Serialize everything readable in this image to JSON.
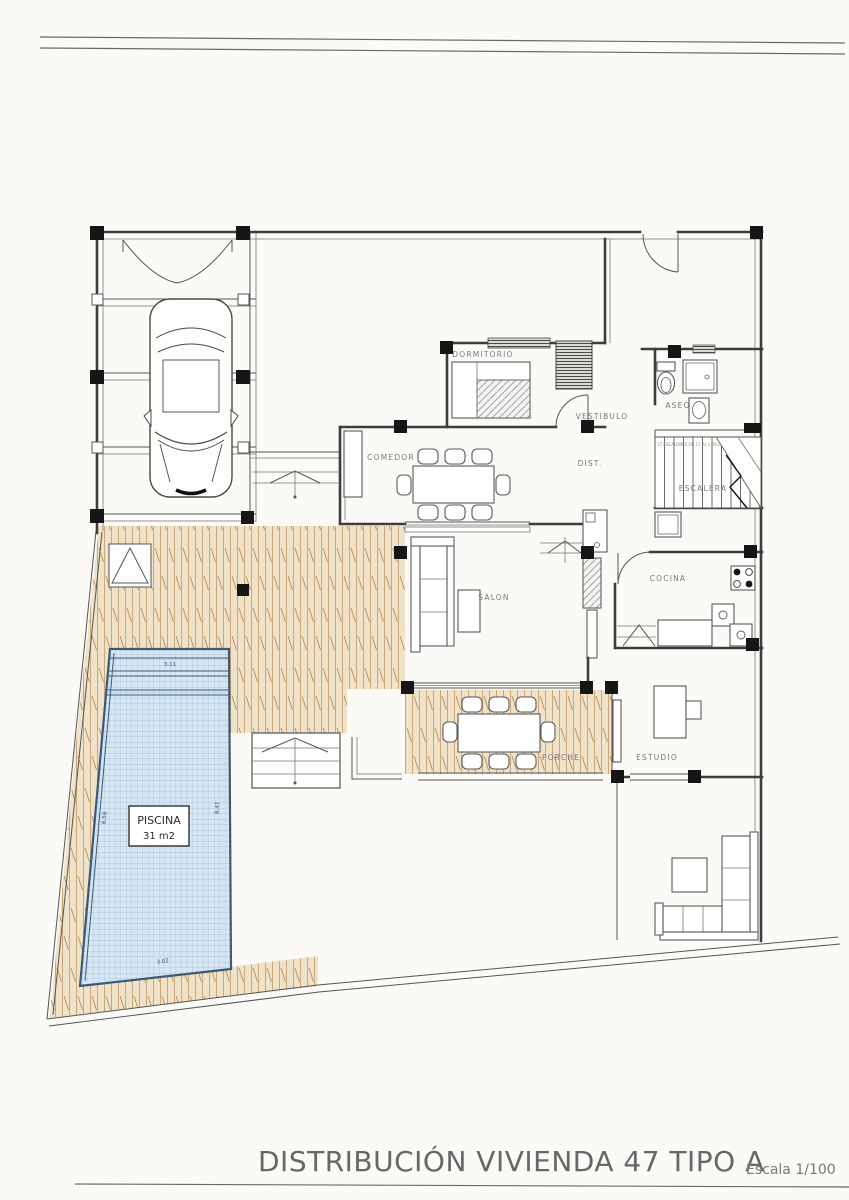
{
  "page": {
    "title": "DISTRIBUCIÓN VIVIENDA 47 TIPO A",
    "scale_label": "Escala 1/100"
  },
  "rooms": {
    "dormitorio": "DORMITORIO",
    "vestibulo": "VESTIBULO",
    "aseo": "ASEO",
    "escalera": "ESCALERA",
    "comedor": "COMEDOR",
    "dist": "DIST.",
    "salon": "SALON",
    "cocina": "COCINA",
    "porche": "PORCHE",
    "estudio": "ESTUDIO"
  },
  "pool": {
    "name": "PISCINA",
    "area": "31 m2",
    "dim_top": "3.11",
    "dim_left": "6.58",
    "dim_right": "8.47",
    "dim_bottom": "3.02"
  },
  "stairs": {
    "note": "17 ESCALONES DE 17 RL x 28.0"
  },
  "colors": {
    "deck": "#f0e2c8",
    "deck_line": "#c9a87e",
    "pool_fill": "#d6e6f3",
    "pool_grid": "#a3c1dc",
    "pool_border": "#3c5a77",
    "line": "#3d3d3d",
    "title": "#676767"
  }
}
